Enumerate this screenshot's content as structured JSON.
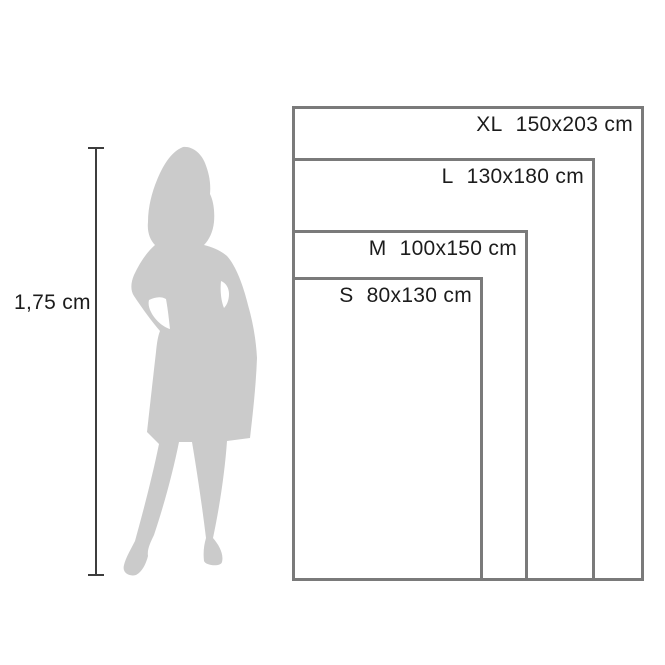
{
  "figure": {
    "height_label": "1,75 cm",
    "silhouette": "woman-silhouette"
  },
  "sizes": [
    {
      "size": "XL",
      "dimensions": "150x203 cm"
    },
    {
      "size": "L",
      "dimensions": "130x180 cm"
    },
    {
      "size": "M",
      "dimensions": "100x150 cm"
    },
    {
      "size": "S",
      "dimensions": "80x130 cm"
    }
  ],
  "colors": {
    "silhouette": "#cbcbcb",
    "rect_border": "#7a7a7a",
    "measure_line": "#3d3d3d",
    "text": "#1c1c1c",
    "background": "#ffffff"
  }
}
